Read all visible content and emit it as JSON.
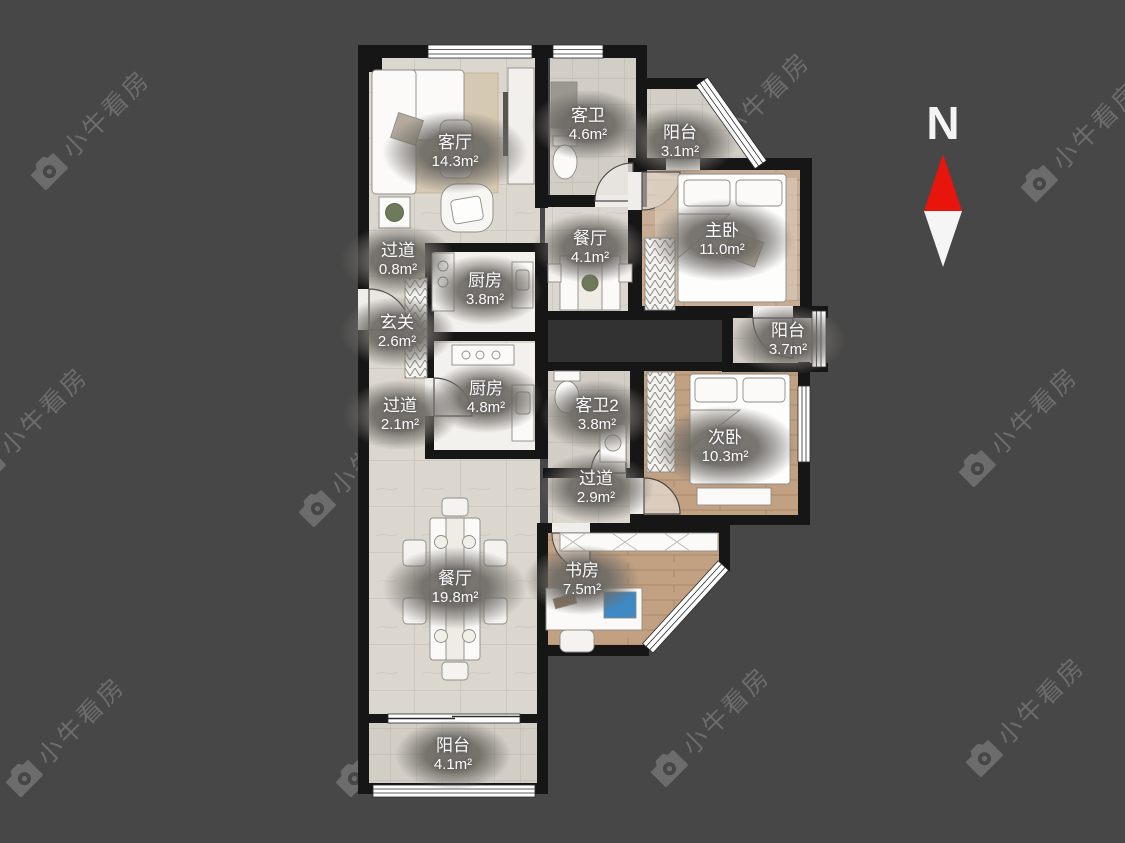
{
  "watermark": {
    "text": "小牛看房"
  },
  "compass": {
    "label": "N",
    "north_color": "#e8150c",
    "south_color": "#f5f5f5"
  },
  "colors": {
    "background": "#474747",
    "wall": "#161616",
    "tile_floor": "#dbd7cf",
    "bath_tile": "#d2cec6",
    "wood_floor": "#c2a183",
    "master_wood": "#c8ad94",
    "label_bubble": "#6e6b66",
    "watermark": "#d7d7d7"
  },
  "rooms": [
    {
      "name": "客厅",
      "area": "14.3m²"
    },
    {
      "name": "客卫",
      "area": "4.6m²"
    },
    {
      "name": "阳台",
      "area": "3.1m²"
    },
    {
      "name": "主卧",
      "area": "11.0m²"
    },
    {
      "name": "过道",
      "area": "0.8m²"
    },
    {
      "name": "餐厅",
      "area": "4.1m²"
    },
    {
      "name": "厨房",
      "area": "3.8m²"
    },
    {
      "name": "玄关",
      "area": "2.6m²"
    },
    {
      "name": "阳台",
      "area": "3.7m²"
    },
    {
      "name": "厨房",
      "area": "4.8m²"
    },
    {
      "name": "过道",
      "area": "2.1m²"
    },
    {
      "name": "客卫2",
      "area": "3.8m²"
    },
    {
      "name": "次卧",
      "area": "10.3m²"
    },
    {
      "name": "过道",
      "area": "2.9m²"
    },
    {
      "name": "餐厅",
      "area": "19.8m²"
    },
    {
      "name": "书房",
      "area": "7.5m²"
    },
    {
      "name": "阳台",
      "area": "4.1m²"
    }
  ]
}
